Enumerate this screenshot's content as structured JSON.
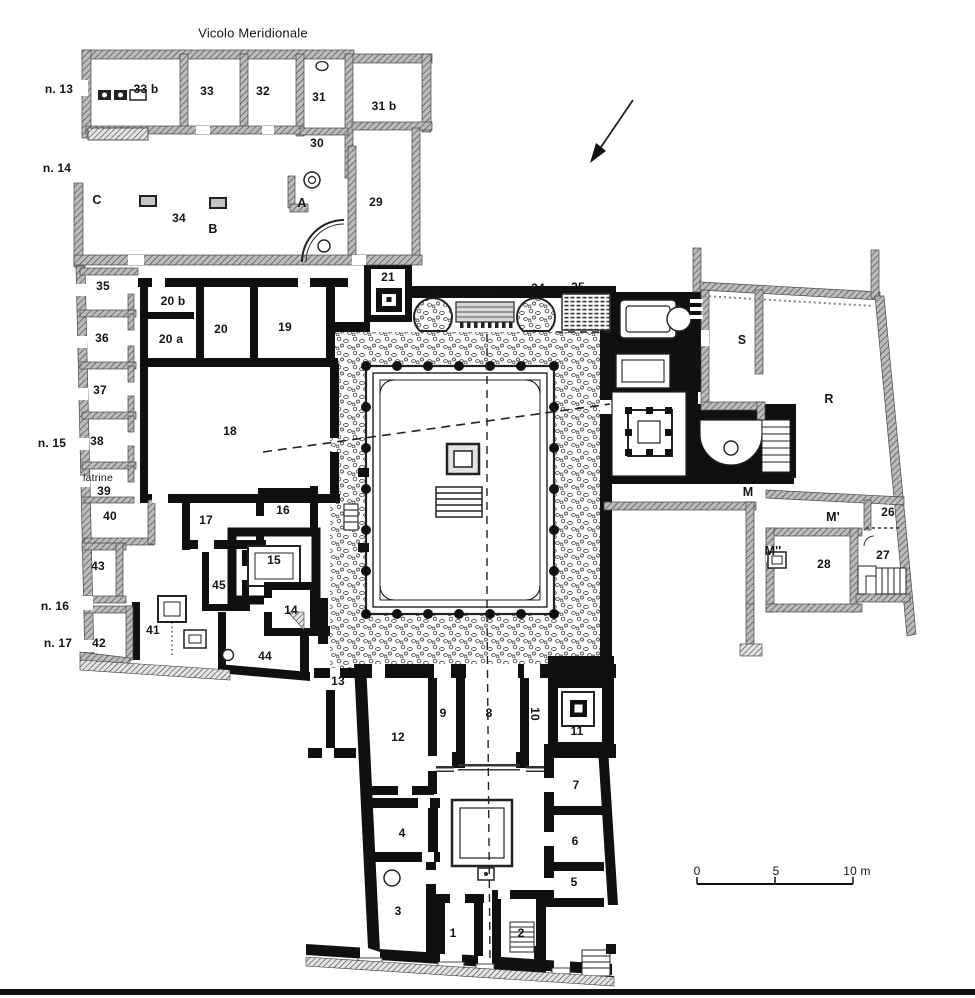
{
  "figure": {
    "type": "archaeological-floor-plan",
    "street_name": "Vicolo Meridionale",
    "scale_bar": {
      "tick_start": "0",
      "tick_mid": "5",
      "tick_end": "10 m"
    },
    "palette": {
      "paper": "#ffffff",
      "ink": "#111111",
      "hatched_wall": "#bcbcbc",
      "stipple": "#555555"
    }
  },
  "labels": [
    {
      "text": "Vicolo Meridionale",
      "x": 253,
      "y": 33,
      "cls": "street"
    },
    {
      "text": "n. 13",
      "x": 59,
      "y": 89,
      "cls": "entrance"
    },
    {
      "text": "n. 14",
      "x": 57,
      "y": 168,
      "cls": "entrance"
    },
    {
      "text": "n. 15",
      "x": 52,
      "y": 443,
      "cls": "entrance"
    },
    {
      "text": "n. 16",
      "x": 55,
      "y": 606,
      "cls": "entrance"
    },
    {
      "text": "n. 17",
      "x": 58,
      "y": 643,
      "cls": "entrance"
    },
    {
      "text": "latrine",
      "x": 98,
      "y": 478,
      "cls": "small"
    },
    {
      "text": "33 b",
      "x": 146,
      "y": 89
    },
    {
      "text": "33",
      "x": 207,
      "y": 91
    },
    {
      "text": "32",
      "x": 263,
      "y": 91
    },
    {
      "text": "31",
      "x": 319,
      "y": 97
    },
    {
      "text": "31 b",
      "x": 384,
      "y": 106
    },
    {
      "text": "30",
      "x": 317,
      "y": 143
    },
    {
      "text": "29",
      "x": 376,
      "y": 202
    },
    {
      "text": "C",
      "x": 97,
      "y": 200,
      "cls": "letter"
    },
    {
      "text": "34",
      "x": 179,
      "y": 218
    },
    {
      "text": "B",
      "x": 213,
      "y": 229,
      "cls": "letter"
    },
    {
      "text": "A",
      "x": 302,
      "y": 203,
      "cls": "letter"
    },
    {
      "text": "35",
      "x": 103,
      "y": 286
    },
    {
      "text": "36",
      "x": 102,
      "y": 338
    },
    {
      "text": "37",
      "x": 100,
      "y": 390
    },
    {
      "text": "38",
      "x": 97,
      "y": 441
    },
    {
      "text": "39",
      "x": 104,
      "y": 491
    },
    {
      "text": "40",
      "x": 110,
      "y": 516
    },
    {
      "text": "43",
      "x": 98,
      "y": 566
    },
    {
      "text": "42",
      "x": 99,
      "y": 643
    },
    {
      "text": "41",
      "x": 153,
      "y": 630
    },
    {
      "text": "20 b",
      "x": 173,
      "y": 301
    },
    {
      "text": "20 a",
      "x": 171,
      "y": 339
    },
    {
      "text": "20",
      "x": 221,
      "y": 329
    },
    {
      "text": "19",
      "x": 285,
      "y": 327
    },
    {
      "text": "18",
      "x": 230,
      "y": 431
    },
    {
      "text": "17",
      "x": 206,
      "y": 520
    },
    {
      "text": "16",
      "x": 283,
      "y": 510
    },
    {
      "text": "15",
      "x": 274,
      "y": 560
    },
    {
      "text": "45",
      "x": 219,
      "y": 585
    },
    {
      "text": "14",
      "x": 291,
      "y": 610
    },
    {
      "text": "44",
      "x": 265,
      "y": 656
    },
    {
      "text": "13",
      "x": 338,
      "y": 681
    },
    {
      "text": "21",
      "x": 388,
      "y": 277
    },
    {
      "text": "22",
      "x": 434,
      "y": 294
    },
    {
      "text": "23",
      "x": 486,
      "y": 292
    },
    {
      "text": "24",
      "x": 538,
      "y": 288
    },
    {
      "text": "25",
      "x": 578,
      "y": 287
    },
    {
      "text": "S",
      "x": 742,
      "y": 340,
      "cls": "letter"
    },
    {
      "text": "R",
      "x": 829,
      "y": 399,
      "cls": "letter"
    },
    {
      "text": "M",
      "x": 748,
      "y": 492,
      "cls": "letter"
    },
    {
      "text": "M'",
      "x": 833,
      "y": 517,
      "cls": "letter"
    },
    {
      "text": "M''",
      "x": 773,
      "y": 551,
      "cls": "letter"
    },
    {
      "text": "26",
      "x": 888,
      "y": 512
    },
    {
      "text": "27",
      "x": 883,
      "y": 555
    },
    {
      "text": "28",
      "x": 824,
      "y": 564
    },
    {
      "text": "12",
      "x": 398,
      "y": 737
    },
    {
      "text": "9",
      "x": 443,
      "y": 713
    },
    {
      "text": "8",
      "x": 489,
      "y": 713
    },
    {
      "text": "10",
      "x": 535,
      "y": 714,
      "cls": "rot90"
    },
    {
      "text": "11",
      "x": 577,
      "y": 731
    },
    {
      "text": "7",
      "x": 576,
      "y": 785
    },
    {
      "text": "6",
      "x": 575,
      "y": 841
    },
    {
      "text": "5",
      "x": 574,
      "y": 882
    },
    {
      "text": "4",
      "x": 402,
      "y": 833
    },
    {
      "text": "3",
      "x": 398,
      "y": 911
    },
    {
      "text": "1",
      "x": 453,
      "y": 933
    },
    {
      "text": "2",
      "x": 521,
      "y": 933
    },
    {
      "text": "0",
      "x": 697,
      "y": 871,
      "cls": "scale"
    },
    {
      "text": "5",
      "x": 776,
      "y": 871,
      "cls": "scale"
    },
    {
      "text": "10 m",
      "x": 857,
      "y": 871,
      "cls": "scale"
    }
  ]
}
